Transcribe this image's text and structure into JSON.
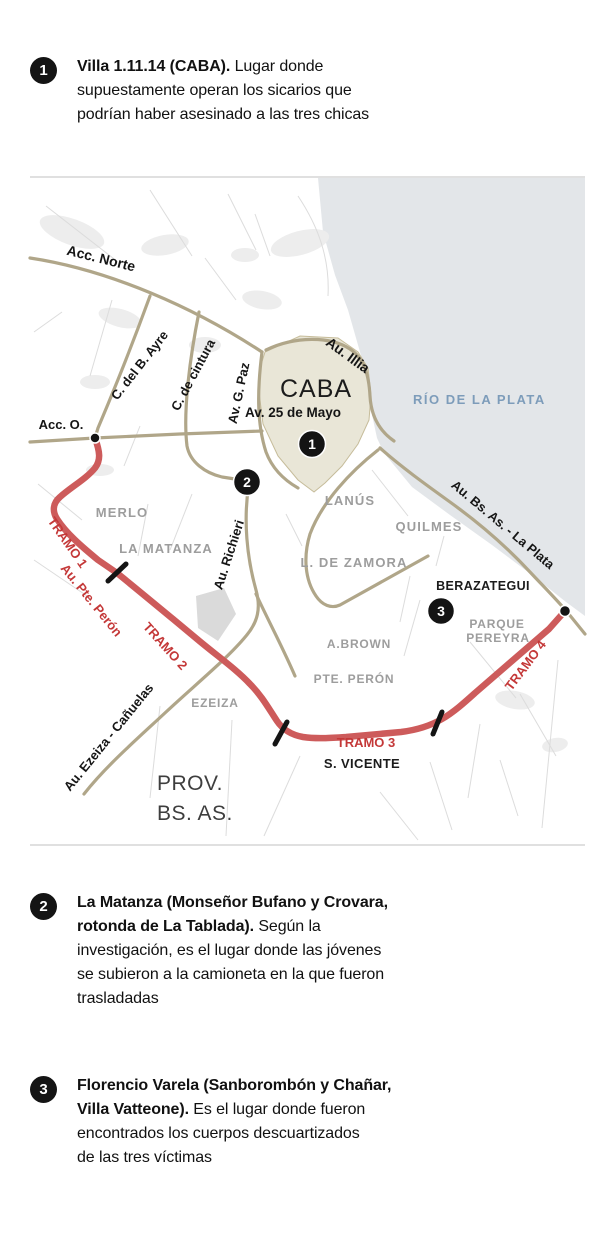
{
  "theme": {
    "route_red": "#cd5b5b",
    "label_red": "#c43838",
    "road_tan": "#b0a689",
    "water": "#e3e6e9",
    "water_text": "#7d9cba",
    "caba_fill": "#e9e6d7",
    "caba_stroke": "#c6bc9a",
    "gray_label": "#9d9d9d",
    "minor_road": "#dcdcdc",
    "patch": "#ededed"
  },
  "annotations": [
    {
      "number": "1",
      "bold": "Villa 1.11.14 (CABA).",
      "text": " Lugar donde\nsupuestamente operan los sicarios que\npodrían haber asesinado a las tres chicas"
    },
    {
      "number": "2",
      "bold": "La Matanza (Monseñor Bufano y Crovara,\nrotonda de La Tablada).",
      "text": " Según la\ninvestigación, es el lugar donde las jóvenes\nse subieron a la camioneta en la que fueron\ntrasladadas"
    },
    {
      "number": "3",
      "bold": "Florencio Varela (Sanborombón y Chañar,\nVilla Vatteone).",
      "text": " Es el lugar donde fueron\nencontrados los cuerpos descuartizados\nde las tres víctimas"
    }
  ],
  "map": {
    "markers": [
      {
        "number": "1"
      },
      {
        "number": "2"
      },
      {
        "number": "3"
      }
    ],
    "labels": {
      "acc_norte": "Acc. Norte",
      "c_del_b_ayre": "C. del B. Ayre",
      "c_de_cintura": "C. de cintura",
      "av_g_paz": "Av. G. Paz",
      "au_illia": "Au. Illia",
      "acc_o": "Acc. O.",
      "caba": "CABA",
      "av_25_de_mayo": "Av. 25 de Mayo",
      "rio_de_la_plata": "RÍO DE LA PLATA",
      "au_richieri": "Au. Richieri",
      "au_bs_as_la_plata": "Au. Bs. As. - La Plata",
      "au_ezeiza_canuelas": "Au. Ezeiza - Cañuelas",
      "merlo": "MERLO",
      "la_matanza": "LA MATANZA",
      "lanus": "LANÚS",
      "quilmes": "QUILMES",
      "l_de_zamora": "L. DE ZAMORA",
      "berazategui": "BERAZATEGUI",
      "parque_pereyra_line1": "PARQUE",
      "parque_pereyra_line2": "PEREYRA",
      "a_brown": "A.BROWN",
      "pte_peron": "PTE. PERÓN",
      "ezeiza": "EZEIZA",
      "s_vicente": "S. VICENTE",
      "prov_line1": "PROV.",
      "prov_line2": "BS. AS."
    },
    "route_labels": {
      "tramo1": "TRAMO 1",
      "au_pte_peron": "Au. Pte. Perón",
      "tramo2": "TRAMO 2",
      "tramo3": "TRAMO 3",
      "tramo4": "TRAMO 4"
    }
  }
}
